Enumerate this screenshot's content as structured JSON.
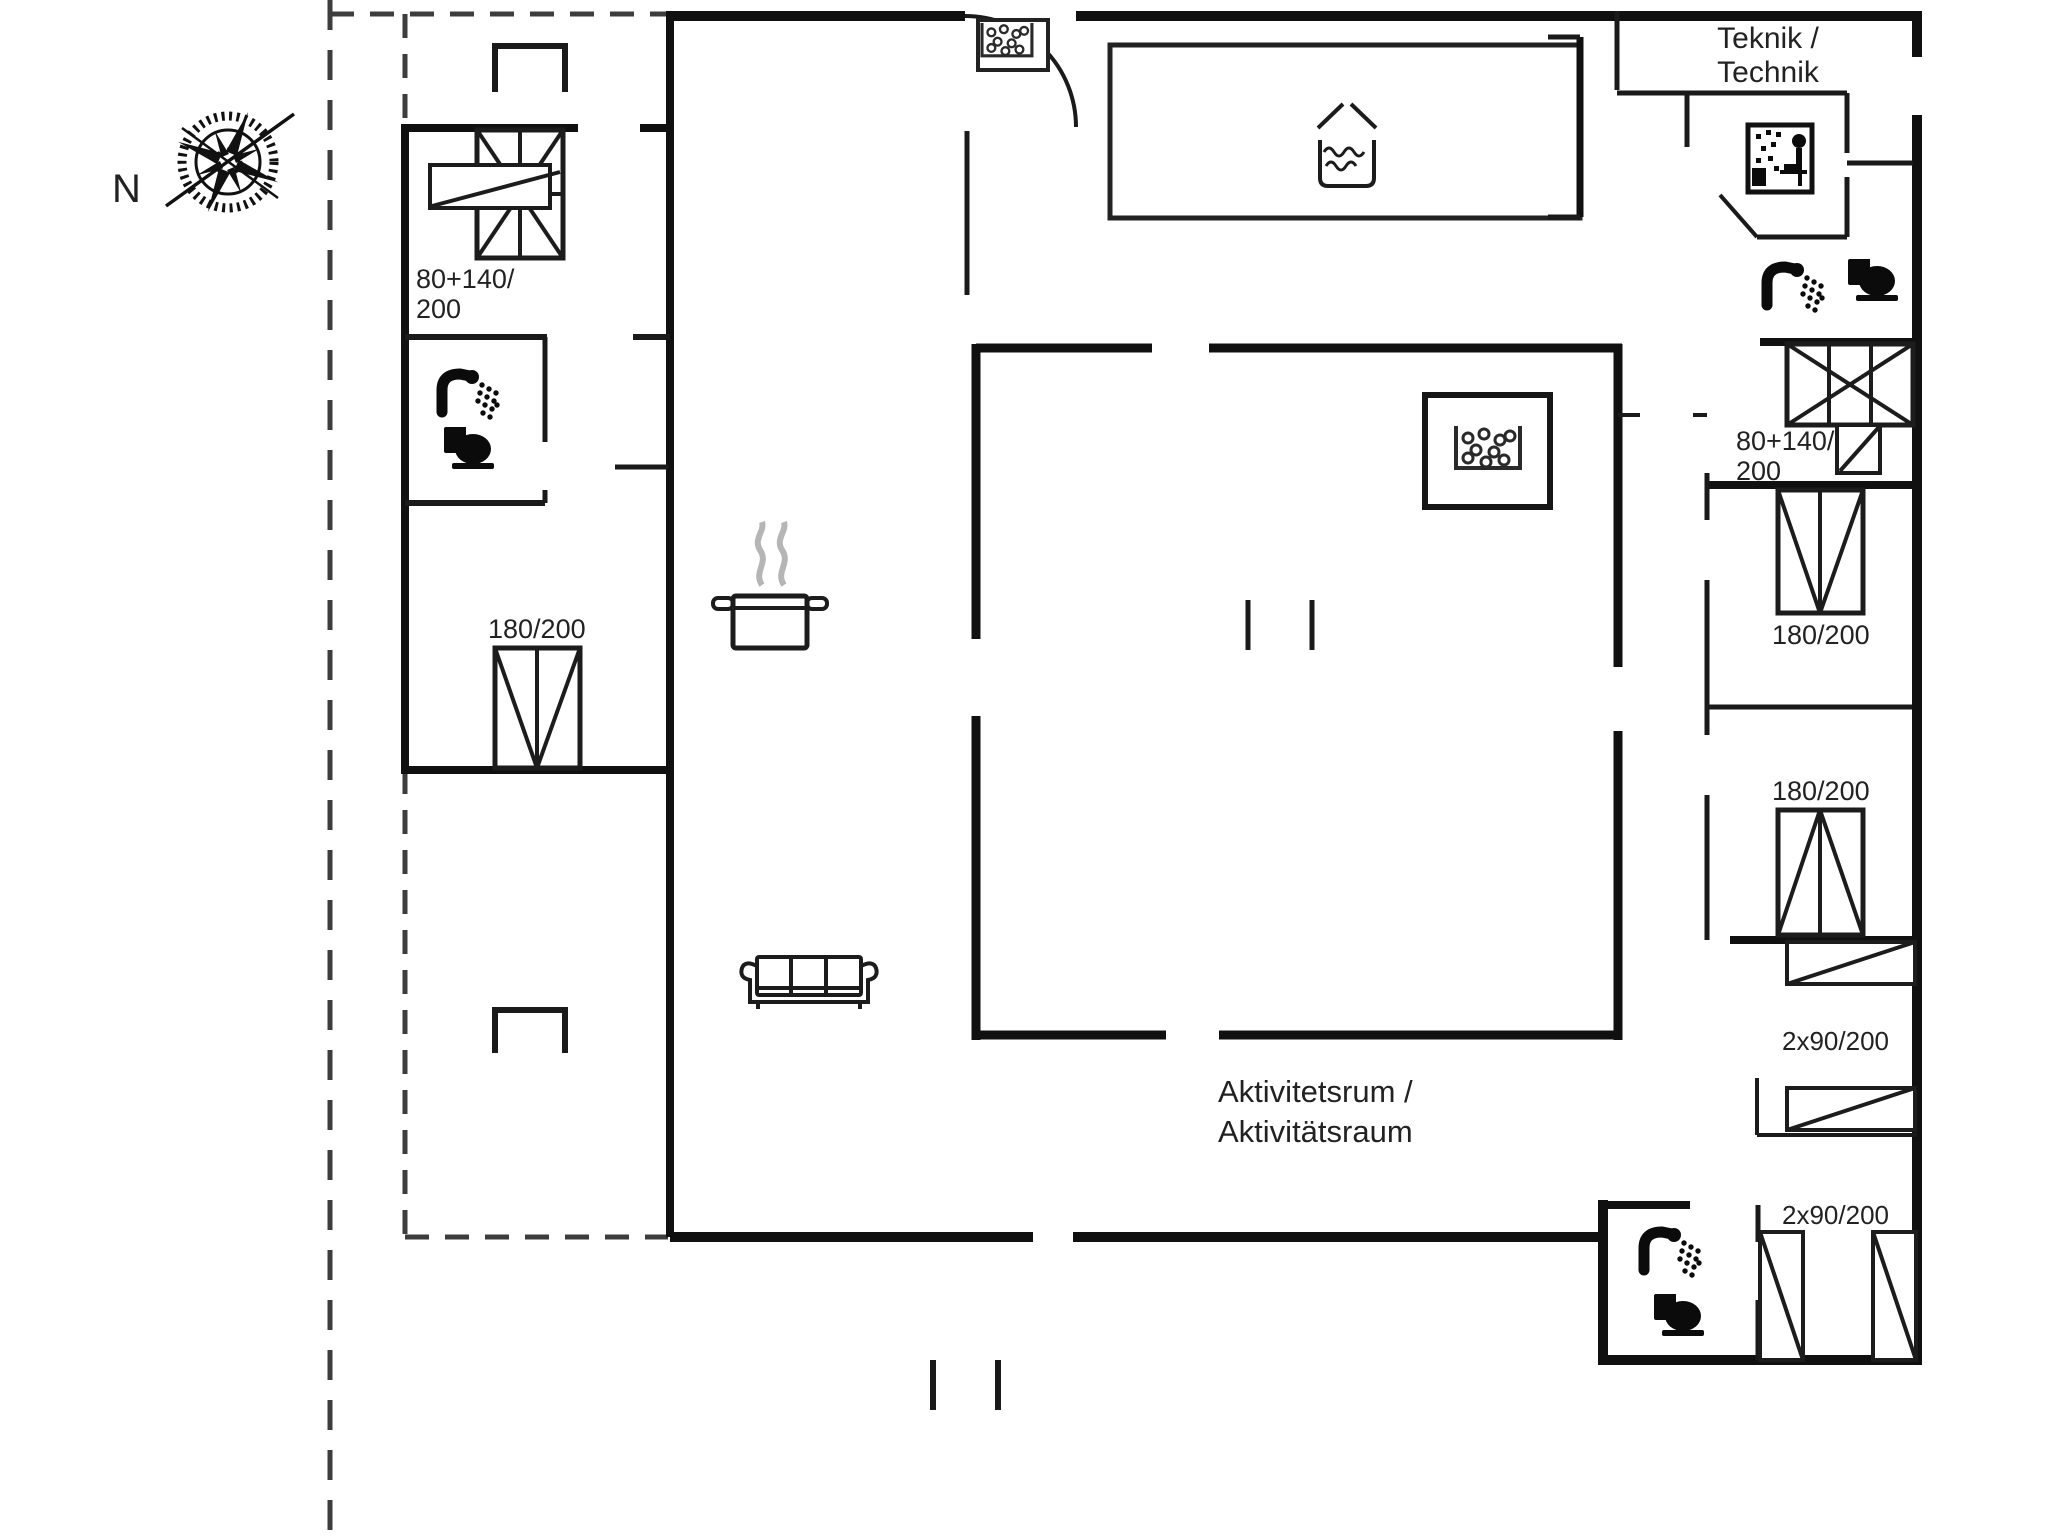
{
  "title": "Floor plan",
  "colors": {
    "background": "#ffffff",
    "walls": "#101010",
    "labels": "#222222",
    "dashed_boundary": "#3d3d3d",
    "steam": "#b5b5b5"
  },
  "compass": {
    "label": "N"
  },
  "rooms": {
    "teknik": {
      "label_line1": "Teknik /",
      "label_line2": "Technik"
    },
    "activity": {
      "label_line1": "Aktivitetsrum /",
      "label_line2": "Aktivitätsraum"
    }
  },
  "beds": {
    "bunk_top_left": {
      "size_line1": "80+140/",
      "size_line2": "200"
    },
    "double_bed_left": {
      "size": "180/200"
    },
    "bunk_top_right": {
      "size_line1": "80+140/",
      "size_line2": "200"
    },
    "double_bed_right_upper": {
      "size": "180/200"
    },
    "double_bed_right_lower": {
      "size": "180/200"
    },
    "single_beds_middle": {
      "size": "2x90/200"
    },
    "single_beds_bottom": {
      "size": "2x90/200"
    }
  },
  "icons": {
    "names": [
      "compass-icon",
      "whirlpool-icon",
      "mini-whirlpool-icon",
      "pool-icon",
      "cooking-pot-icon",
      "shower-icon",
      "toilet-icon",
      "sauna-icon",
      "sofa-icon",
      "door-arc-icon"
    ]
  }
}
